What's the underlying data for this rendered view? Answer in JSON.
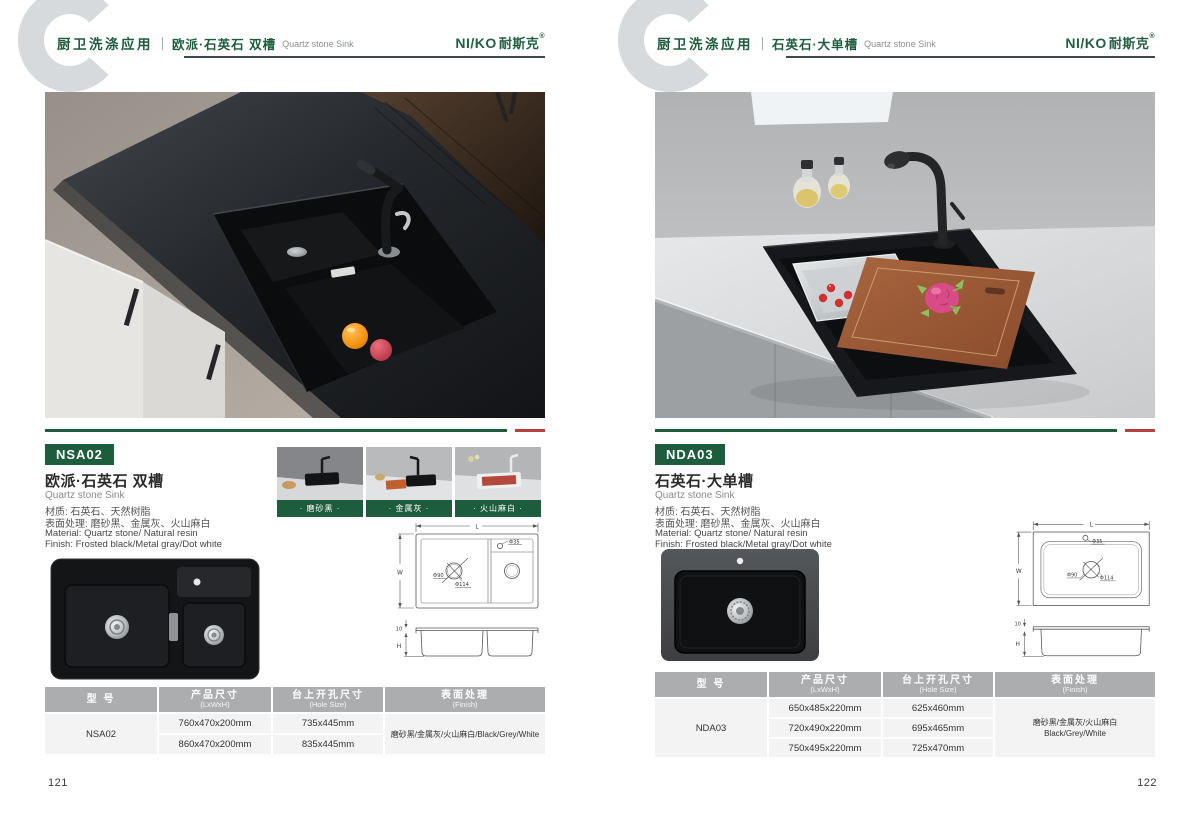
{
  "brand": {
    "logo_text": "NI/KO",
    "logo_cn": "耐斯克",
    "logo_reg": "®"
  },
  "pages": [
    {
      "page_number": "121",
      "header": {
        "category": "厨卫洗涤应用",
        "title_cn": "欧派·石英石 双槽",
        "title_en": "Quartz stone Sink"
      },
      "product": {
        "model": "NSA02",
        "name_cn": "欧派·石英石 双槽",
        "name_en": "Quartz stone Sink",
        "material_cn": "材质: 石英石、天然树脂",
        "surface_cn": "表面处理: 磨砂黑、金属灰、火山麻白",
        "material_en": "Material: Quartz stone/ Natural resin",
        "finish_en": "Finish: Frosted black/Metal gray/Dot white"
      },
      "swatches": [
        {
          "label": "· 磨砂黑 ·"
        },
        {
          "label": "· 金属灰 ·"
        },
        {
          "label": "· 火山麻白 ·"
        }
      ],
      "drawing": {
        "L": "L",
        "W": "W",
        "H": "H",
        "hole": "Φ35",
        "drain_small": "Φ90",
        "drain_large": "Φ114",
        "depth": "10"
      },
      "table": {
        "headers": [
          {
            "main": "型 号",
            "sub": ""
          },
          {
            "main": "产品尺寸",
            "sub": "(LxWxH)"
          },
          {
            "main": "台上开孔尺寸",
            "sub": "(Hole Size)"
          },
          {
            "main": "表面处理",
            "sub": "(Finish)"
          }
        ],
        "model": "NSA02",
        "rows": [
          {
            "size": "760x470x200mm",
            "hole": "735x445mm"
          },
          {
            "size": "860x470x200mm",
            "hole": "835x445mm"
          }
        ],
        "finish_lines": [
          "磨砂黑/金属灰/火山麻白/Black/Grey/White"
        ]
      }
    },
    {
      "page_number": "122",
      "header": {
        "category": "厨卫洗涤应用",
        "title_cn": "石英石·大单槽",
        "title_en": "Quartz stone Sink"
      },
      "product": {
        "model": "NDA03",
        "name_cn": "石英石·大单槽",
        "name_en": "Quartz stone Sink",
        "material_cn": "材质: 石英石、天然树脂",
        "surface_cn": "表面处理: 磨砂黑、金属灰、火山麻白",
        "material_en": "Material: Quartz stone/ Natural resin",
        "finish_en": "Finish: Frosted black/Metal gray/Dot white"
      },
      "drawing": {
        "L": "L",
        "W": "W",
        "H": "H",
        "hole": "Φ35",
        "drain_small": "Φ90",
        "drain_large": "Φ114",
        "depth": "10"
      },
      "table": {
        "headers": [
          {
            "main": "型 号",
            "sub": ""
          },
          {
            "main": "产品尺寸",
            "sub": "(LxWxH)"
          },
          {
            "main": "台上开孔尺寸",
            "sub": "(Hole Size)"
          },
          {
            "main": "表面处理",
            "sub": "(Finish)"
          }
        ],
        "model": "NDA03",
        "rows": [
          {
            "size": "650x485x220mm",
            "hole": "625x460mm"
          },
          {
            "size": "720x490x220mm",
            "hole": "695x465mm"
          },
          {
            "size": "750x495x220mm",
            "hole": "725x470mm"
          }
        ],
        "finish_lines": [
          "磨砂黑/金属灰/火山麻白",
          "Black/Grey/White"
        ]
      }
    }
  ],
  "colors": {
    "brand_green": "#1d5c3d",
    "accent_red": "#b5403c",
    "table_header_gray": "#abadaf"
  }
}
